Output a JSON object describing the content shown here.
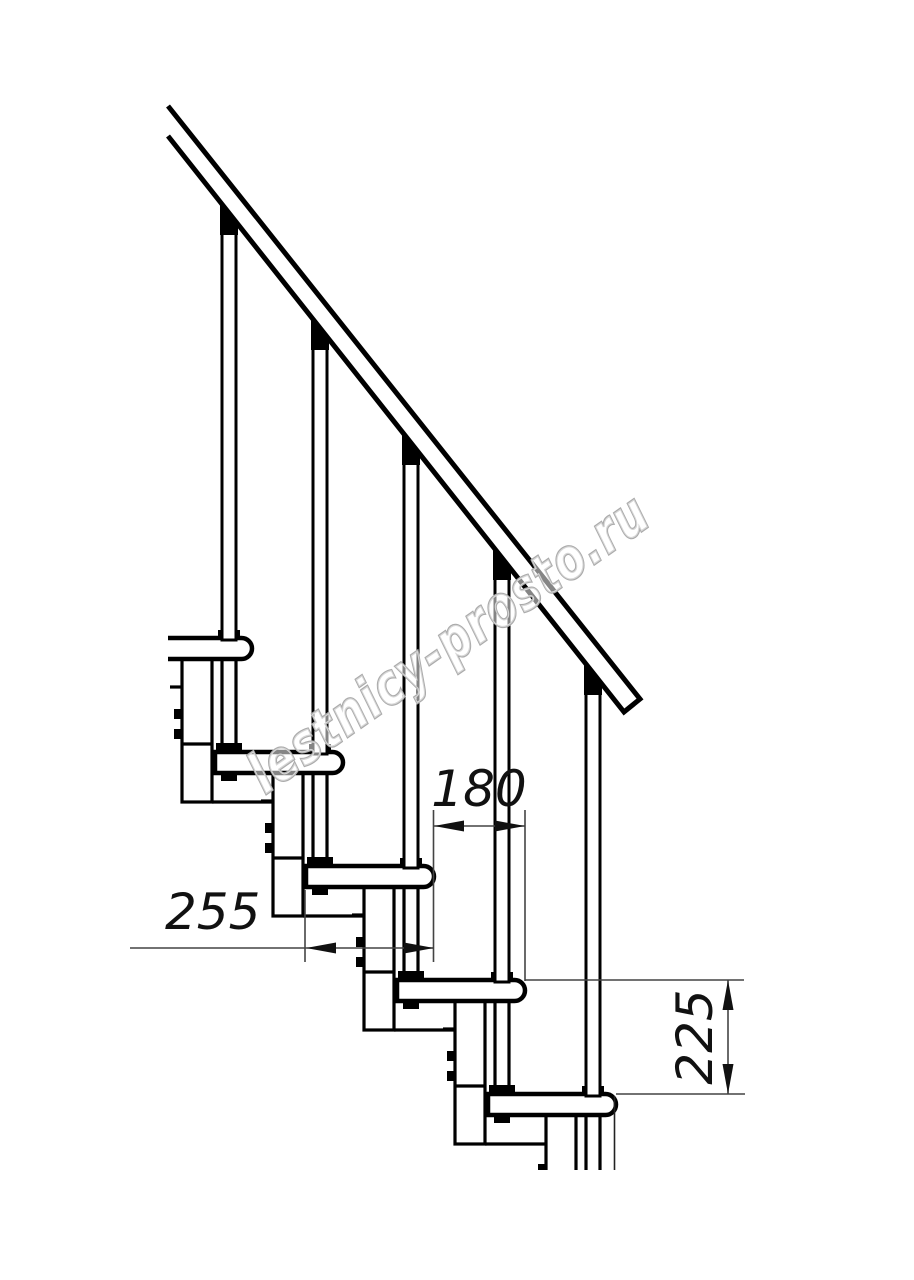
{
  "drawing": {
    "subject": "modular staircase side view",
    "watermark": {
      "text": "lestnicy-prosto.ru"
    },
    "dimensions": {
      "run": {
        "label": "180"
      },
      "depth": {
        "label": "255"
      },
      "rise": {
        "label": "225"
      }
    },
    "colors": {
      "line": "#000000",
      "dimension_line": "#444444",
      "dimension_text": "#111111",
      "watermark_outline": "#ababab",
      "background": "#ffffff"
    }
  }
}
